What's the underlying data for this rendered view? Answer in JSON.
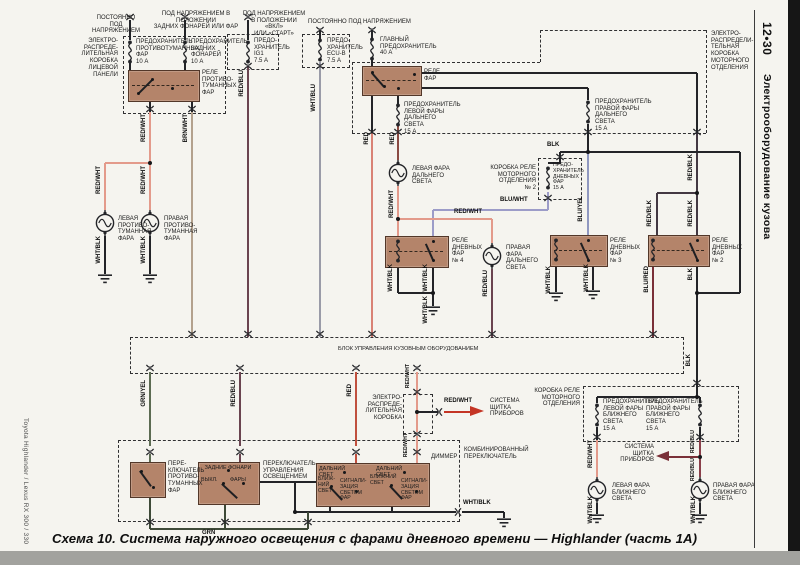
{
  "page": {
    "caption": "Схема 10. Система наружного освещения с фарами дневного времени — Highlander (часть 1А)",
    "margin_left": "Toyota Highlander / Lexus RX 300 / 330",
    "margin_right_code": "12•30",
    "margin_right_title": "Электрооборудование кузова"
  },
  "diagram": {
    "texts": [
      {
        "n": "hdr-constant-power-left",
        "t": "ПОСТОЯННО\nПОД НАПРЯЖЕНИЕМ",
        "x": 86,
        "y": 15,
        "w": 60,
        "a": "c"
      },
      {
        "n": "hdr-power-tail-position",
        "t": "ПОД НАПРЯЖЕНИЕМ В ПОЛОЖЕНИИ\nЗАДНИХ ФОНАРЕЙ ИЛИ ФАР",
        "x": 150,
        "y": 11,
        "w": 92,
        "a": "c"
      },
      {
        "n": "hdr-power-on-start",
        "t": "ПОД НАПРЯЖЕНИЕМ\nВ ПОЛОЖЕНИИ «ВКЛ»\nИЛИ «СТАРТ»",
        "x": 242,
        "y": 11,
        "w": 64,
        "a": "c"
      },
      {
        "n": "hdr-constant-power-right",
        "t": "ПОСТОЯННО ПОД НАПРЯЖЕНИЕМ",
        "x": 308,
        "y": 19,
        "w": 120
      },
      {
        "n": "lbl-ip-junction-box",
        "t": "ЭЛЕКТРО-\nРАСПРЕДЕ-\nЛИТЕЛЬНАЯ\nКОРОБКА\nЛИЦЕВОЙ\nПАНЕЛИ",
        "x": 62,
        "y": 38,
        "w": 56,
        "a": "r"
      },
      {
        "n": "lbl-fuse-foglamp",
        "t": "ПРЕДОХРАНИТЕЛЬ\nПРОТИВОТУМАННЫХ\nФАР\n10 А",
        "x": 136,
        "y": 39,
        "w": 50
      },
      {
        "n": "lbl-fuse-tail",
        "t": "ПРЕДОХРАНИТЕЛЬ\nЗАДНИХ ФОНАРЕЙ\n10 А",
        "x": 191,
        "y": 39,
        "w": 46
      },
      {
        "n": "lbl-fog-relay",
        "t": "РЕЛЕ\nПРОТИВО-\nТУМАННЫХ\nФАР",
        "x": 202,
        "y": 70,
        "w": 28
      },
      {
        "n": "lbl-fuse-ig1",
        "t": "ПРЕДО-\nХРАНИТЕЛЬ\nIG1\n7.5 А",
        "x": 254,
        "y": 38,
        "w": 30
      },
      {
        "n": "lbl-fuse-ecub",
        "t": "ПРЕДО-\nХРАНИТЕЛЬ\nECU-B\n7.5 А",
        "x": 327,
        "y": 38,
        "w": 30
      },
      {
        "n": "lbl-main-fuse",
        "t": "ГЛАВНЫЙ\nПРЕДОХРАНИТЕЛЬ\n40 А",
        "x": 380,
        "y": 37,
        "w": 52
      },
      {
        "n": "lbl-headlamp-relay",
        "t": "РЕЛЕ\nФАР",
        "x": 424,
        "y": 69,
        "w": 24
      },
      {
        "n": "lbl-fuse-lh-high",
        "t": "ПРЕДОХРАНИТЕЛЬ\nЛЕВОЙ ФАРЫ\nДАЛЬНЕГО СВЕТА\n15 А",
        "x": 404,
        "y": 102,
        "w": 50
      },
      {
        "n": "lbl-fuse-rh-high",
        "t": "ПРЕДОХРАНИТЕЛЬ\nПРАВОЙ ФАРЫ\nДАЛЬНЕГО СВЕТА\n15 А",
        "x": 595,
        "y": 99,
        "w": 50
      },
      {
        "n": "lbl-engine-junction-box",
        "t": "ЭЛЕКТРО-\nРАСПРЕДЕЛИ-\nТЕЛЬНАЯ\nКОРОБКА\nМОТОРНОГО\nОТДЕЛЕНИЯ",
        "x": 711,
        "y": 31,
        "w": 42
      },
      {
        "n": "lbl-lh-high-lamp",
        "t": "ЛЕВАЯ ФАРА\nДАЛЬНЕГО СВЕТА",
        "x": 412,
        "y": 166,
        "w": 52
      },
      {
        "n": "lbl-rh-high-lamp",
        "t": "ПРАВАЯ\nФАРА\nДАЛЬНЕГО\nСВЕТА",
        "x": 506,
        "y": 245,
        "w": 34
      },
      {
        "n": "lbl-lh-fog-lamp",
        "t": "ЛЕВАЯ\nПРОТИВО-\nТУМАННАЯ\nФАРА",
        "x": 118,
        "y": 216,
        "w": 34
      },
      {
        "n": "lbl-rh-fog-lamp",
        "t": "ПРАВАЯ\nПРОТИВО-\nТУМАННАЯ\nФАРА",
        "x": 164,
        "y": 216,
        "w": 34
      },
      {
        "n": "lbl-relay-box-no2",
        "t": "КОРОБКА РЕЛЕ\nМОТОРНОГО\nОТДЕЛЕНИЯ\n№ 2",
        "x": 488,
        "y": 165,
        "w": 48,
        "a": "r"
      },
      {
        "n": "lbl-fuse-drl",
        "t": "ПРЕДО-\nХРАНИТЕЛЬ\nДНЕВНЫХ\nФАР\n15 А",
        "x": 553,
        "y": 163,
        "w": 26,
        "s": 5.2
      },
      {
        "n": "lbl-drl-relay-4",
        "t": "РЕЛЕ\nДНЕВНЫХ\nФАР\n№ 4",
        "x": 452,
        "y": 238,
        "w": 30
      },
      {
        "n": "lbl-drl-relay-3",
        "t": "РЕЛЕ\nДНЕВНЫХ\nФАР\n№ 3",
        "x": 610,
        "y": 238,
        "w": 30
      },
      {
        "n": "lbl-drl-relay-2",
        "t": "РЕЛЕ\nДНЕВНЫХ\nФАР\n№ 2",
        "x": 712,
        "y": 238,
        "w": 30
      },
      {
        "n": "lbl-body-ecu",
        "t": "БЛОК УПРАВЛЕНИЯ КУЗОВНЫМ ОБОРУДОВАНИЕМ",
        "x": 338,
        "y": 346,
        "w": 250,
        "s": 5.6
      },
      {
        "n": "lbl-jb-small",
        "t": "ЭЛЕКТРО-\nРАСПРЕДЕ-\nЛИТЕЛЬНАЯ\nКОРОБКА",
        "x": 360,
        "y": 395,
        "w": 42,
        "a": "r"
      },
      {
        "n": "lbl-gauge-system-top",
        "t": "СИСТЕМА\nЩИТКА\nПРИБОРОВ",
        "x": 490,
        "y": 398,
        "w": 40
      },
      {
        "n": "lbl-relay-box-bottom",
        "t": "КОРОБКА РЕЛЕ\nМОТОРНОГО\nОТДЕЛЕНИЯ",
        "x": 532,
        "y": 388,
        "w": 48,
        "a": "r"
      },
      {
        "n": "lbl-fuse-lh-low",
        "t": "ПРЕДОХРАНИТЕЛЬ\nЛЕВОЙ ФАРЫ\nБЛИЖНЕГО СВЕТА\n15 А",
        "x": 603,
        "y": 399,
        "w": 48
      },
      {
        "n": "lbl-fuse-rh-low",
        "t": "ПРЕДОХРАНИТЕЛЬ\nПРАВОЙ ФАРЫ\nБЛИЖНЕГО СВЕТА\n15 А",
        "x": 646,
        "y": 399,
        "w": 48
      },
      {
        "n": "lbl-gauge-system-bottom",
        "t": "СИСТЕМА\nЩИТКА\nПРИБОРОВ",
        "x": 612,
        "y": 444,
        "w": 42,
        "a": "r"
      },
      {
        "n": "lbl-lh-low-lamp",
        "t": "ЛЕВАЯ ФАРА\nБЛИЖНЕГО СВЕТА",
        "x": 612,
        "y": 483,
        "w": 52
      },
      {
        "n": "lbl-rh-low-lamp",
        "t": "ПРАВАЯ ФАРА\nБЛИЖНЕГО СВЕТА",
        "x": 713,
        "y": 483,
        "w": 52
      },
      {
        "n": "lbl-combination-switch",
        "t": "КОМБИНИРОВАННЫЙ\nПЕРЕКЛЮЧАТЕЛЬ",
        "x": 464,
        "y": 447,
        "w": 64
      },
      {
        "n": "lbl-fog-switch",
        "t": "ПЕРЕ-\nКЛЮЧАТЕЛЬ\nПРОТИВО-\nТУМАННЫХ\nФАР",
        "x": 168,
        "y": 461,
        "w": 34
      },
      {
        "n": "lbl-light-control-switch",
        "t": "ПЕРЕКЛЮЧАТЕЛЬ\nУПРАВЛЕНИЯ\nОСВЕЩЕНИЕМ",
        "x": 263,
        "y": 461,
        "w": 48
      },
      {
        "n": "sw-pos-tail",
        "t": "ЗАДНИЕ  ФОНАРИ",
        "x": 200,
        "y": 465,
        "w": 56,
        "a": "c",
        "s": 5.4
      },
      {
        "n": "sw-pos-off",
        "t": "ВЫКЛ.",
        "x": 201,
        "y": 477,
        "w": 20,
        "s": 5.4
      },
      {
        "n": "sw-pos-head",
        "t": "ФАРЫ",
        "x": 230,
        "y": 477,
        "w": 20,
        "s": 5.4
      },
      {
        "n": "dim-high-left",
        "t": "ДАЛЬНИЙ СВЕТ",
        "x": 319,
        "y": 466,
        "w": 40,
        "s": 5.4
      },
      {
        "n": "dim-low-left",
        "t": "БЛИЖ-\nНИЙ\nСВЕТ",
        "x": 318,
        "y": 477,
        "w": 18,
        "s": 5.2
      },
      {
        "n": "dim-flash-left",
        "t": "СИГНАЛИ-\nЗАЦИЯ\nСВЕТОМ\nФАР",
        "x": 340,
        "y": 479,
        "w": 24,
        "s": 5.2
      },
      {
        "n": "dim-high-right",
        "t": "ДАЛЬНИЙ СВЕТ",
        "x": 376,
        "y": 466,
        "w": 40,
        "s": 5.4
      },
      {
        "n": "dim-low-right",
        "t": "БЛИЖНИЙ\nСВЕТ",
        "x": 370,
        "y": 475,
        "w": 26,
        "s": 5.2
      },
      {
        "n": "dim-flash-right",
        "t": "СИГНАЛИ-\nЗАЦИЯ\nСВЕТОМ\nФАР",
        "x": 401,
        "y": 479,
        "w": 24,
        "s": 5.2
      },
      {
        "n": "lbl-dimmer",
        "t": "ДИММЕР",
        "x": 431,
        "y": 454,
        "w": 30
      },
      {
        "n": "wl-red-wht-1",
        "t": "RED/WHT",
        "x": 141,
        "y": 114,
        "v": 1,
        "wl": 1
      },
      {
        "n": "wl-brn-wht",
        "t": "BRN/WHT",
        "x": 183,
        "y": 114,
        "v": 1,
        "wl": 1
      },
      {
        "n": "wl-red-blu-top",
        "t": "RED/BLU",
        "x": 239,
        "y": 70,
        "v": 1,
        "wl": 1
      },
      {
        "n": "wl-wht-blu",
        "t": "WHT/BLU",
        "x": 311,
        "y": 84,
        "v": 1,
        "wl": 1
      },
      {
        "n": "wl-red-1",
        "t": "RED",
        "x": 364,
        "y": 132,
        "v": 1,
        "wl": 1
      },
      {
        "n": "wl-red-2",
        "t": "RED",
        "x": 390,
        "y": 132,
        "v": 1,
        "wl": 1
      },
      {
        "n": "wl-red-wht-fog-l",
        "t": "RED/WHT",
        "x": 96,
        "y": 166,
        "v": 1,
        "wl": 1
      },
      {
        "n": "wl-red-wht-fog-r",
        "t": "RED/WHT",
        "x": 141,
        "y": 166,
        "v": 1,
        "wl": 1
      },
      {
        "n": "wl-wht-blk-fog-l",
        "t": "WHT/BLK",
        "x": 96,
        "y": 236,
        "v": 1,
        "wl": 1
      },
      {
        "n": "wl-wht-blk-fog-r",
        "t": "WHT/BLK",
        "x": 141,
        "y": 236,
        "v": 1,
        "wl": 1
      },
      {
        "n": "wl-red-wht-high",
        "t": "RED/WHT",
        "x": 389,
        "y": 190,
        "v": 1,
        "wl": 1
      },
      {
        "n": "wl-blu-yel",
        "t": "BLU/YEL",
        "x": 578,
        "y": 196,
        "v": 1,
        "wl": 1
      },
      {
        "n": "wl-red-blk-1",
        "t": "RED/BLK",
        "x": 688,
        "y": 154,
        "v": 1,
        "wl": 1
      },
      {
        "n": "wl-red-blk-2",
        "t": "RED/BLK",
        "x": 647,
        "y": 200,
        "v": 1,
        "wl": 1
      },
      {
        "n": "wl-red-blk-3",
        "t": "RED/BLK",
        "x": 688,
        "y": 200,
        "v": 1,
        "wl": 1
      },
      {
        "n": "wl-wht-blk-r4a",
        "t": "WHT/BLK",
        "x": 388,
        "y": 264,
        "v": 1,
        "wl": 1
      },
      {
        "n": "wl-wht-blk-r4b",
        "t": "WHT/BLK",
        "x": 423,
        "y": 264,
        "v": 1,
        "wl": 1
      },
      {
        "n": "wl-wht-blk-r4c",
        "t": "WHT/BLK",
        "x": 423,
        "y": 296,
        "v": 1,
        "wl": 1
      },
      {
        "n": "wl-red-blu-highr",
        "t": "RED/BLU",
        "x": 483,
        "y": 270,
        "v": 1,
        "wl": 1
      },
      {
        "n": "wl-wht-blk-r3a",
        "t": "WHT/BLK",
        "x": 546,
        "y": 266,
        "v": 1,
        "wl": 1
      },
      {
        "n": "wl-wht-blk-r3b",
        "t": "WHT/BLK",
        "x": 584,
        "y": 264,
        "v": 1,
        "wl": 1
      },
      {
        "n": "wl-blu-red",
        "t": "BLU/RED",
        "x": 644,
        "y": 266,
        "v": 1,
        "wl": 1
      },
      {
        "n": "wl-blk-r2",
        "t": "BLK",
        "x": 688,
        "y": 268,
        "v": 1,
        "wl": 1
      },
      {
        "n": "wl-grn-yel",
        "t": "GRN/YEL",
        "x": 141,
        "y": 380,
        "v": 1,
        "wl": 1
      },
      {
        "n": "wl-red-blu-sw",
        "t": "RED/BLU",
        "x": 231,
        "y": 380,
        "v": 1,
        "wl": 1
      },
      {
        "n": "wl-red-dim",
        "t": "RED",
        "x": 347,
        "y": 384,
        "v": 1,
        "wl": 1
      },
      {
        "n": "wl-red-wht-jb1",
        "t": "RED/WHT",
        "x": 406,
        "y": 364,
        "v": 1,
        "wl": 1,
        "s": 5.2
      },
      {
        "n": "wl-red-wht-jb2",
        "t": "RED/WHT",
        "x": 404,
        "y": 433,
        "v": 1,
        "wl": 1,
        "s": 5.2
      },
      {
        "n": "wl-red-wht-lowl",
        "t": "RED/WHT",
        "x": 588,
        "y": 440,
        "v": 1,
        "wl": 1
      },
      {
        "n": "wl-red-blu-lowr1",
        "t": "RED/BLU",
        "x": 691,
        "y": 430,
        "v": 1,
        "wl": 1,
        "s": 5.2
      },
      {
        "n": "wl-red-blu-lowr2",
        "t": "RED/BLU",
        "x": 691,
        "y": 458,
        "v": 1,
        "wl": 1,
        "s": 5.2
      },
      {
        "n": "wl-wht-blk-lowl",
        "t": "WHT/BLK",
        "x": 588,
        "y": 496,
        "v": 1,
        "wl": 1
      },
      {
        "n": "wl-wht-blk-lowr",
        "t": "WHT/BLK",
        "x": 691,
        "y": 496,
        "v": 1,
        "wl": 1
      },
      {
        "n": "wl-blk-down",
        "t": "BLK",
        "x": 686,
        "y": 354,
        "v": 1,
        "wl": 1
      },
      {
        "n": "wl-blu-wht",
        "t": "BLU/WHT",
        "x": 500,
        "y": 197,
        "wl": 1
      },
      {
        "n": "wl-red-wht-bridge",
        "t": "RED/WHT",
        "x": 454,
        "y": 209,
        "wl": 1
      },
      {
        "n": "wl-blk-bus",
        "t": "BLK",
        "x": 547,
        "y": 142,
        "wl": 1
      },
      {
        "n": "wl-red-wht-arrow",
        "t": "RED/WHT",
        "x": 444,
        "y": 398,
        "wl": 1
      },
      {
        "n": "wl-grn",
        "t": "GRN",
        "x": 202,
        "y": 530,
        "wl": 1
      },
      {
        "n": "wl-wht-blk-combo",
        "t": "WHT/BLK",
        "x": 463,
        "y": 500,
        "wl": 1
      }
    ]
  }
}
